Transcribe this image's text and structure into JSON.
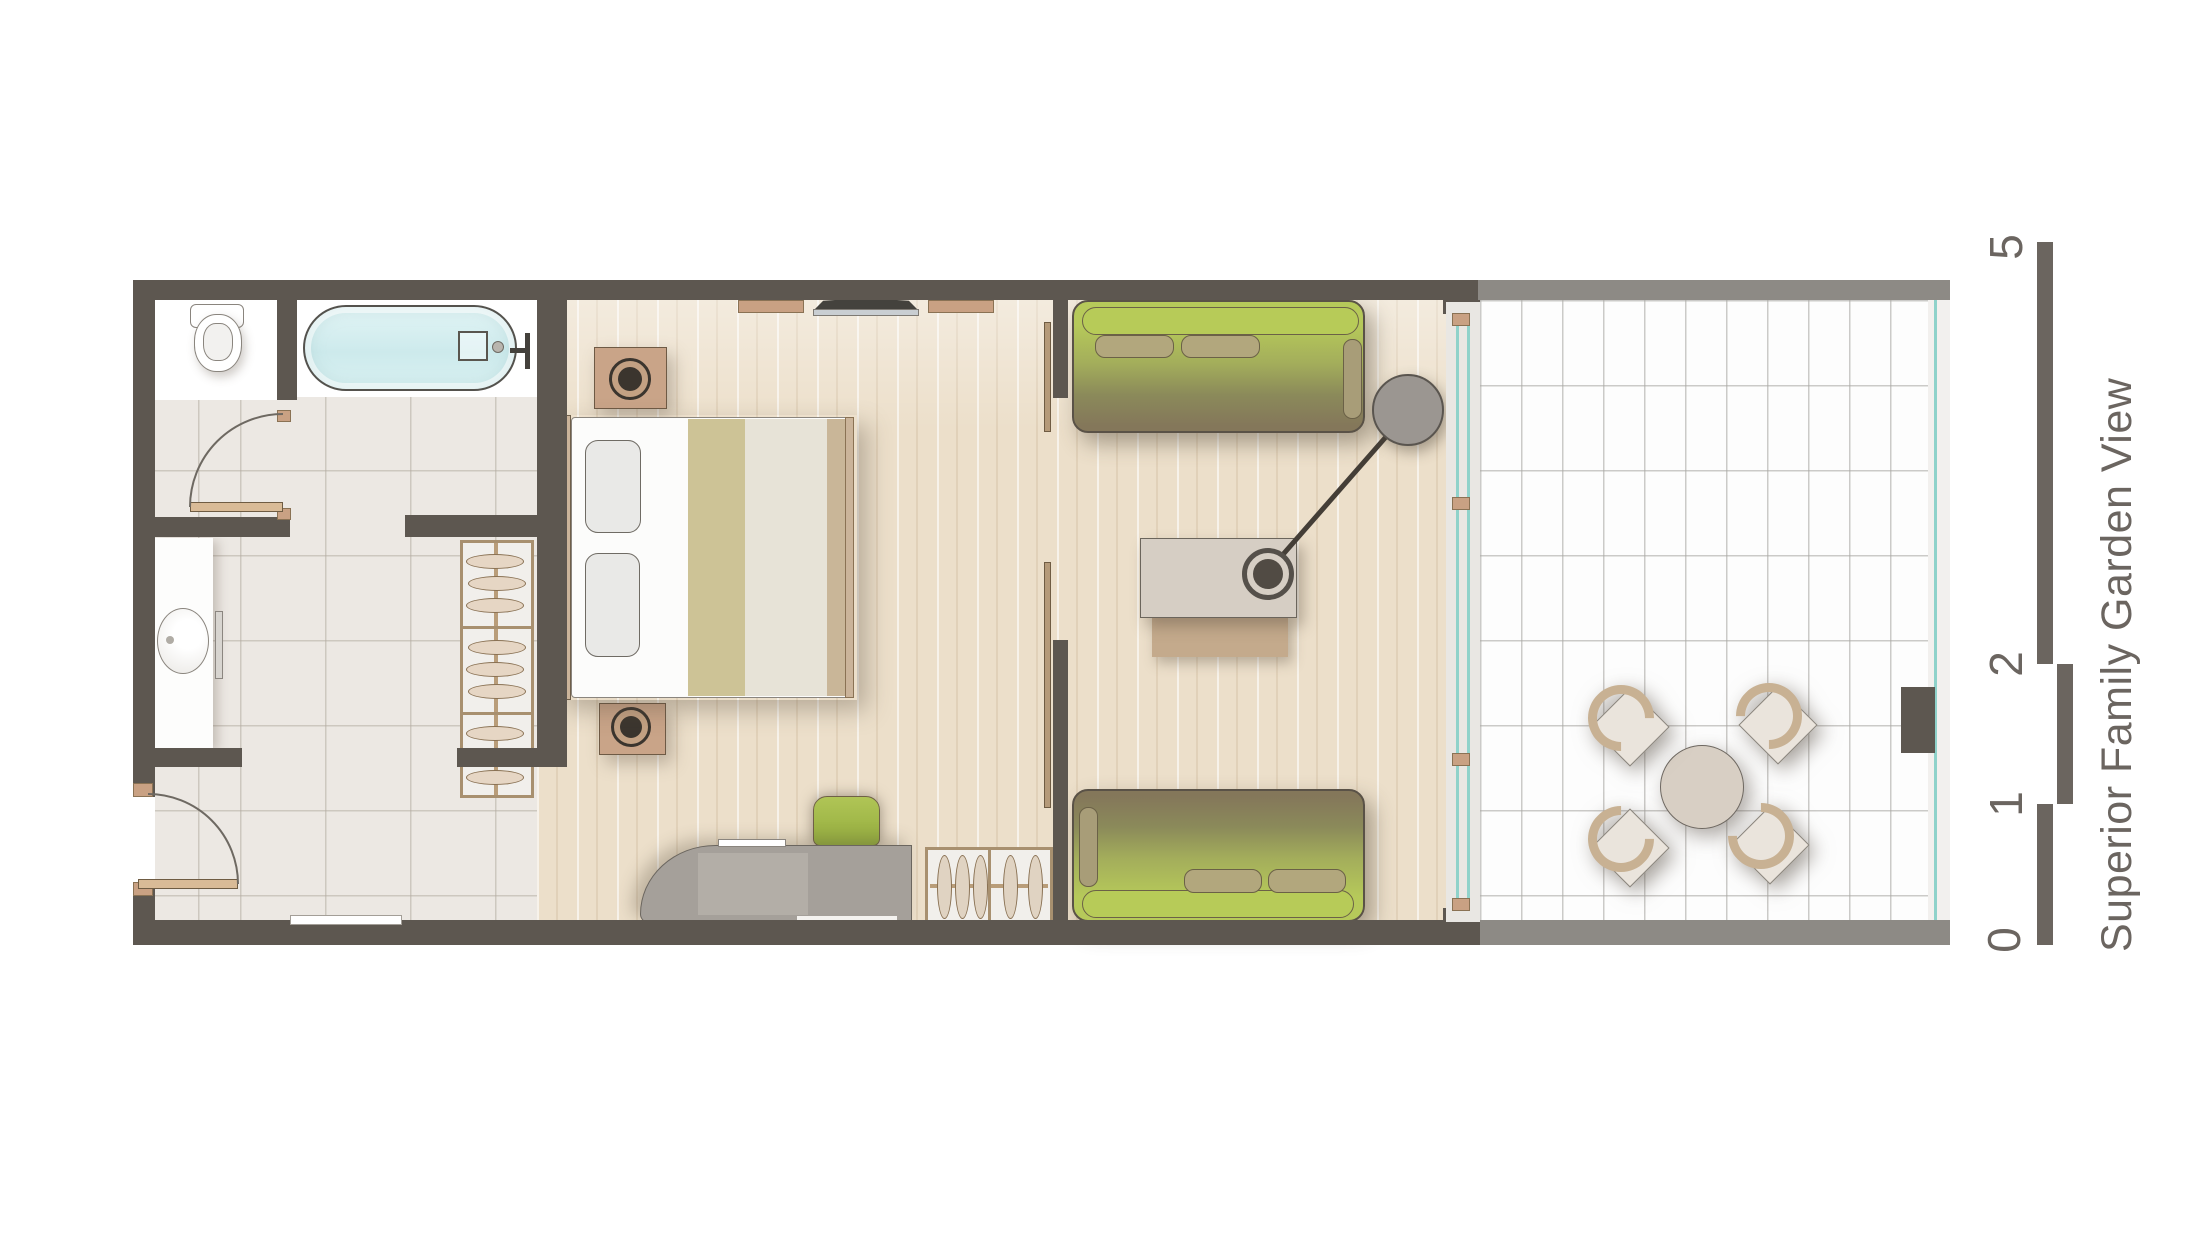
{
  "title": "Superior Family Garden View",
  "scale_bar": {
    "labels": [
      "0",
      "1",
      "2",
      "5"
    ]
  },
  "colors": {
    "wall": "#5d5750",
    "terrace_trim": "#8d8a85",
    "wood_floor": "#ecdfca",
    "tile_floor": "#ece8e3",
    "terrace_tile": "#fdfdfd",
    "sofa_green_bright": "#b6c95a",
    "sofa_olive_dark": "#84775a",
    "cushion_tan": "#b2a77d",
    "furniture_tan": "#c9a183",
    "bathtub_water": "#d6eff1",
    "glass_teal": "#8fd2ca",
    "desk_gray": "#a5a09a",
    "stool_green": "#a9c14e",
    "lamp_gray": "#9b9691",
    "label_gray": "#6b6560"
  }
}
